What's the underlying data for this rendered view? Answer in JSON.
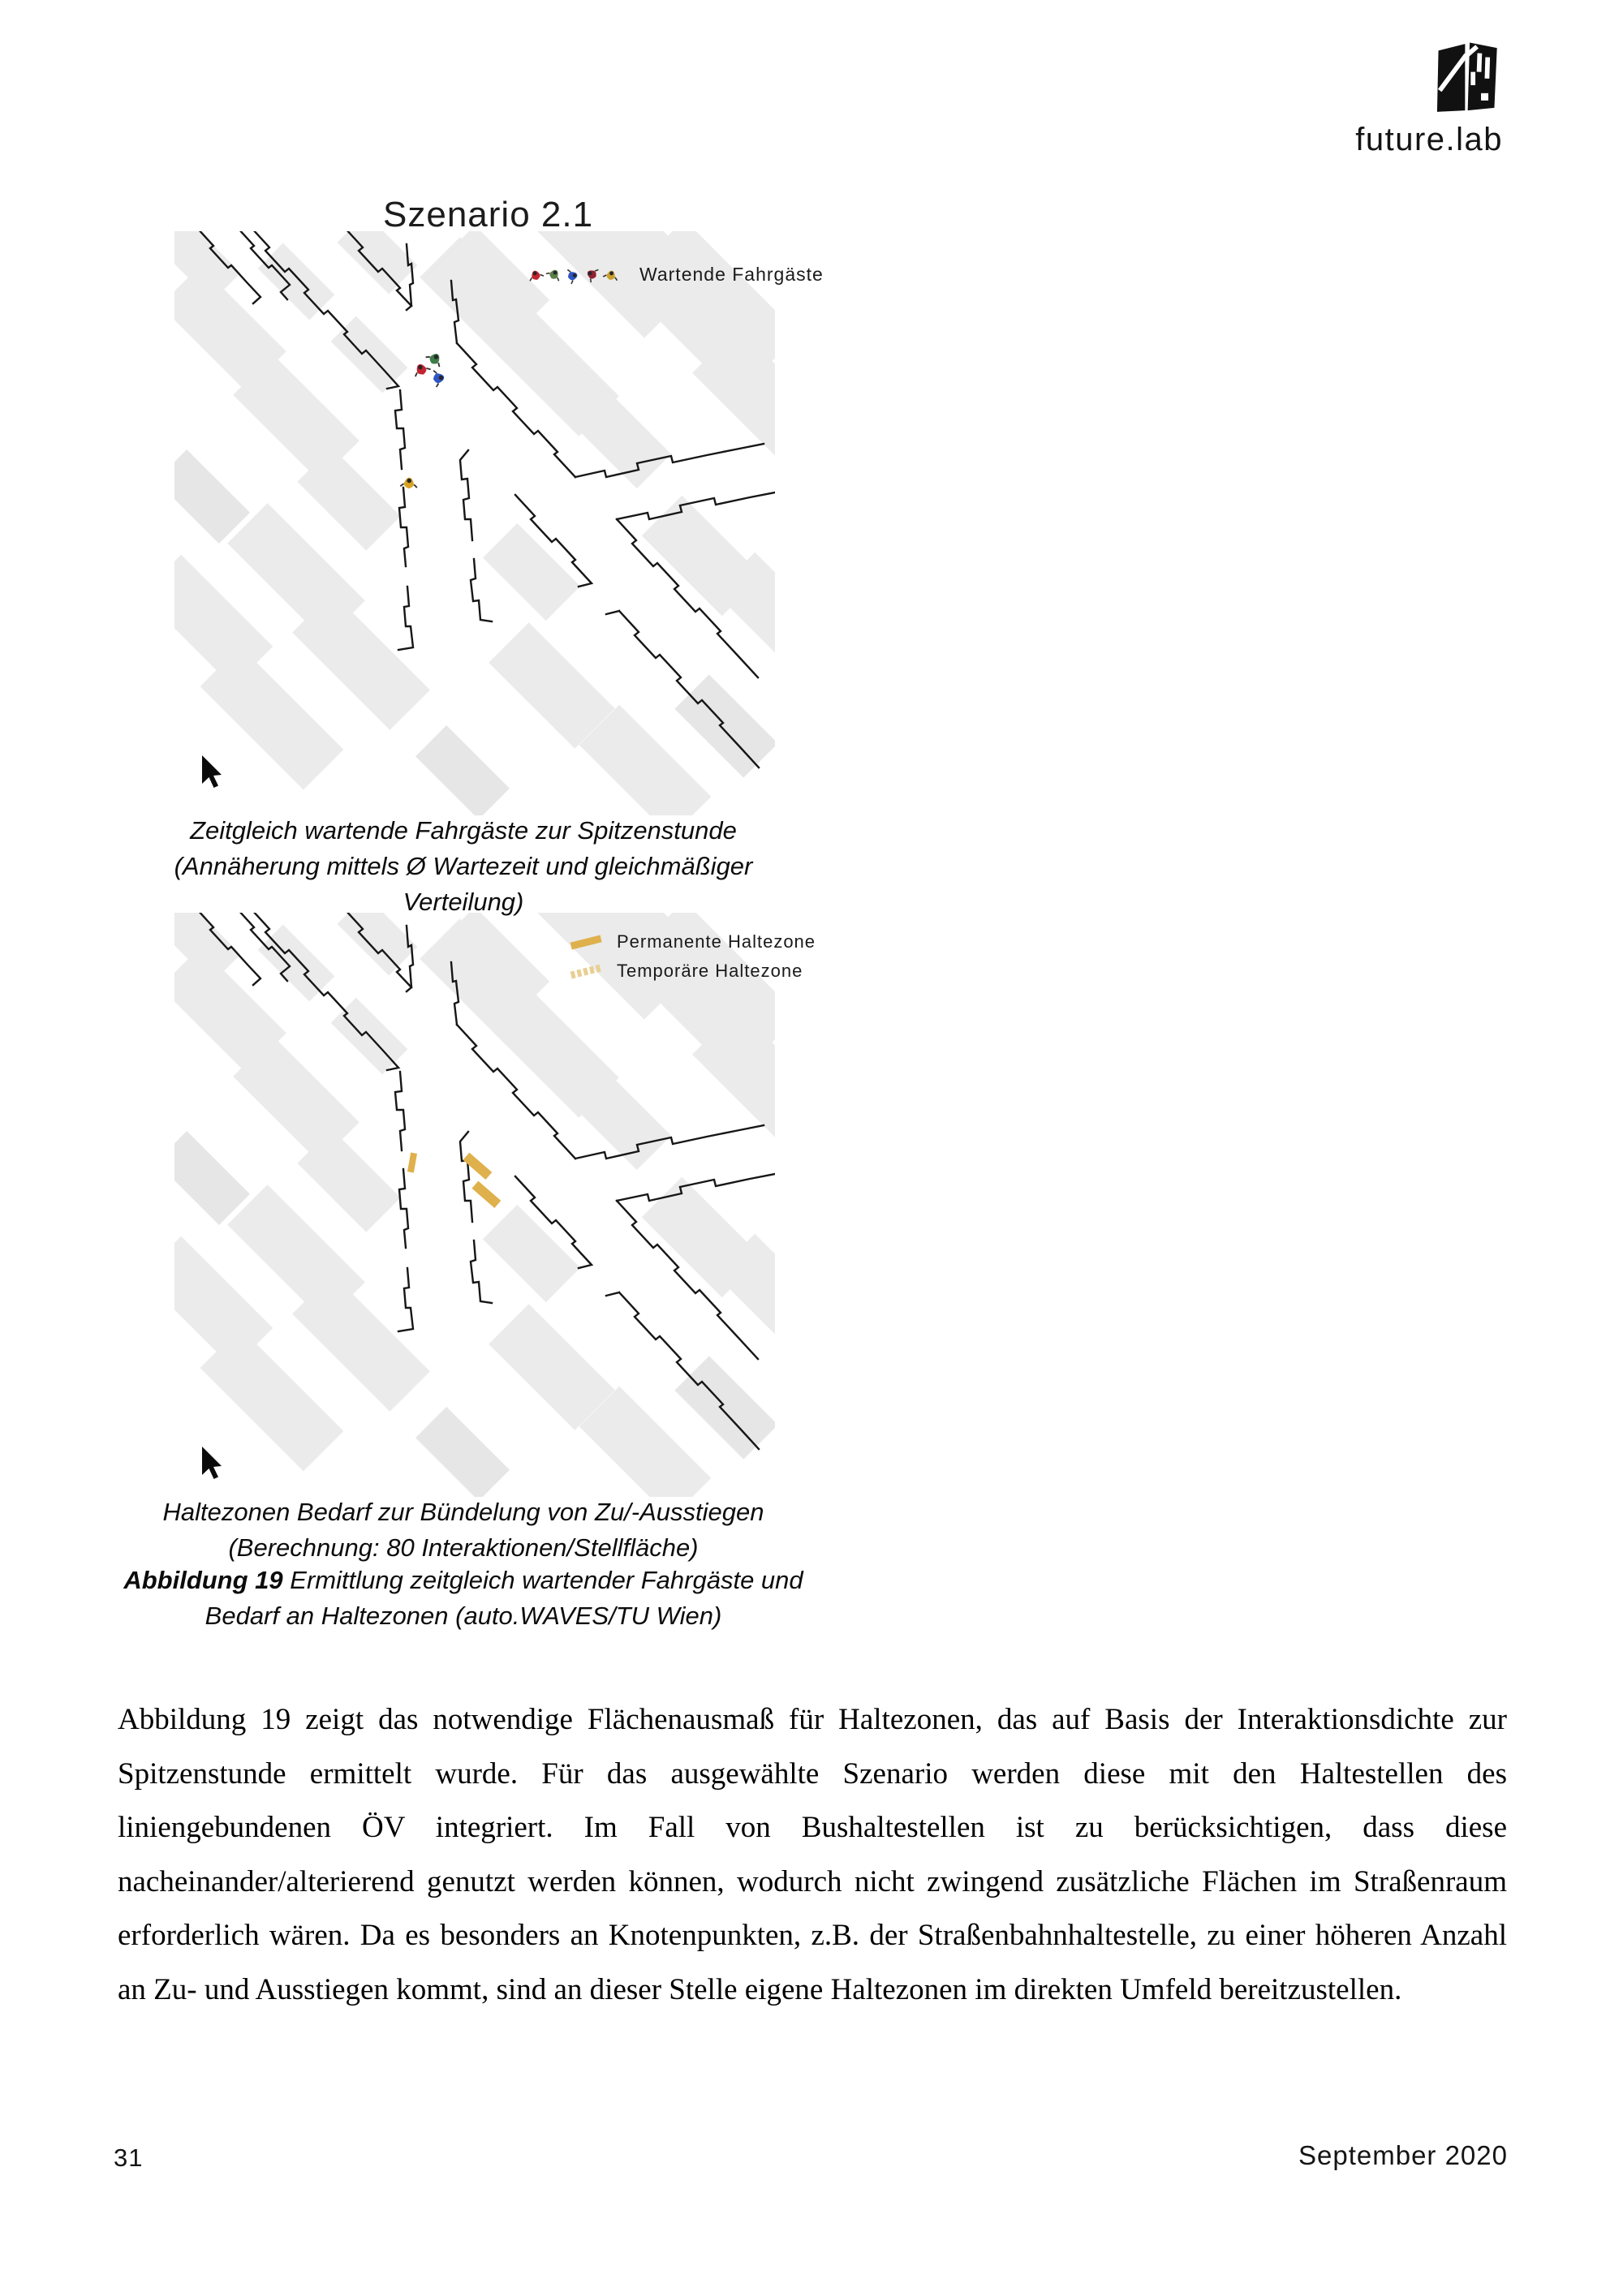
{
  "brand": {
    "name": "future.lab"
  },
  "header": {
    "scenario_title": "Szenario 2.1"
  },
  "map1": {
    "legend_label": "Wartende Fahrgäste",
    "legend_icon_colors": [
      "#c4242f",
      "#5a8046",
      "#2f55c2",
      "#8e2230",
      "#c9a12b"
    ],
    "passenger_colors": [
      "#c4242f",
      "#3f7d49",
      "#2f55c2",
      "#d9a31f"
    ],
    "caption": [
      "Zeitgleich wartende Fahrgäste zur Spitzenstunde",
      "(Annäherung mittels Ø Wartezeit und gleichmäßiger Verteilung)"
    ]
  },
  "map2": {
    "legend": [
      {
        "label": "Permanente Haltezone"
      },
      {
        "label": "Temporäre Haltezone"
      }
    ],
    "caption": [
      "Haltezonen Bedarf zur Bündelung von Zu/-Ausstiegen",
      "(Berechnung: 80 Interaktionen/Stellfläche)"
    ]
  },
  "figure_caption": {
    "label": "Abbildung 19",
    "line1": " Ermittlung zeitgleich wartender Fahrgäste und",
    "line2": "Bedarf an Haltezonen (auto.WAVES/TU Wien)"
  },
  "body": {
    "paragraph": "Abbildung 19 zeigt das notwendige Flächenausmaß für Haltezonen, das auf Basis der Interaktionsdichte zur Spitzenstunde ermittelt wurde. Für das ausgewählte Szenario werden diese mit den Haltestellen des liniengebundenen ÖV integriert. Im Fall von Bushaltestellen ist zu berücksichtigen, dass diese nacheinander/alterierend genutzt werden können, wodurch nicht zwingend zusätzliche Flächen im Straßenraum erforderlich wären. Da es besonders an Knotenpunkten, z.B. der Straßenbahnhaltestelle, zu einer höheren Anzahl an Zu- und Ausstiegen kommt, sind an dieser Stelle eigene Haltezonen im direkten Umfeld bereitzustellen."
  },
  "footer": {
    "page_number": "31",
    "date": "September 2020"
  },
  "colors": {
    "building": "#ebebeb",
    "building_alt": "#e6e6e6",
    "street_line": "#161616",
    "permanent_zone": "#dfb14c",
    "temporary_zone": "#e8cf92"
  }
}
